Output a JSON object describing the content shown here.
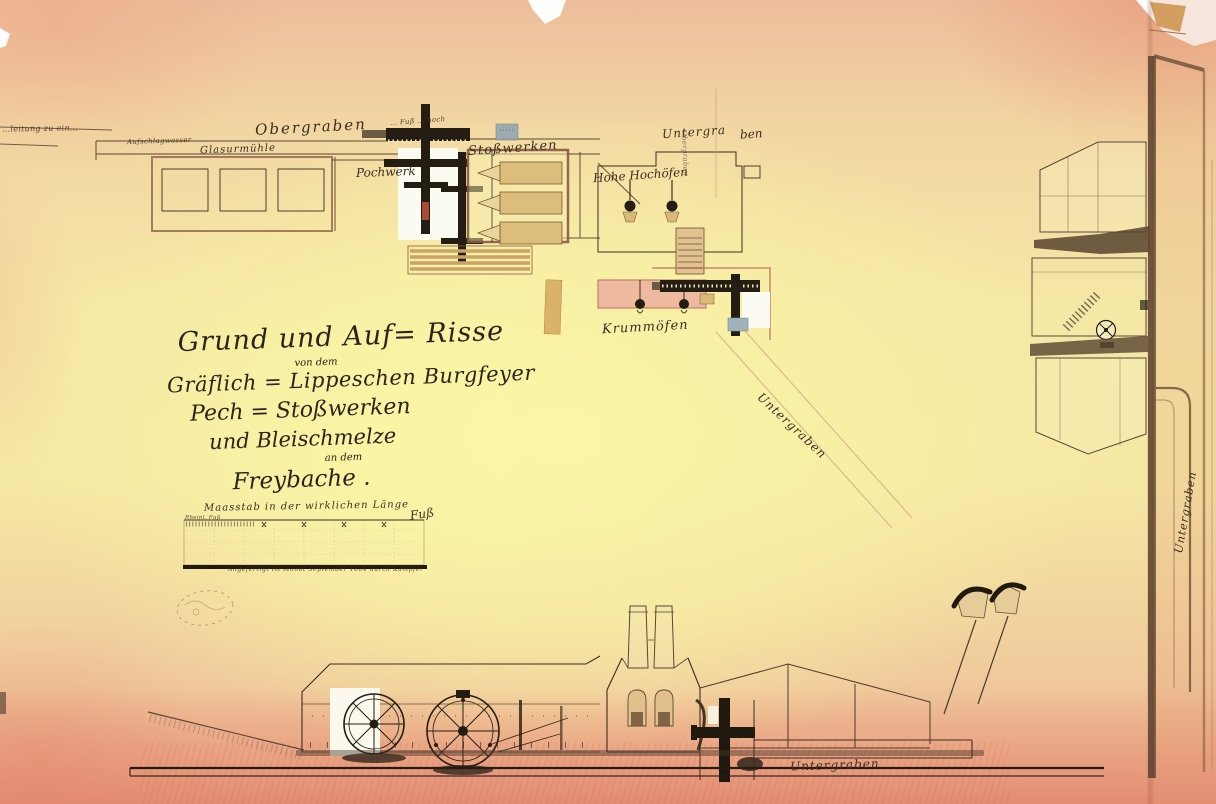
{
  "artwork": {
    "title": {
      "line1": "Grund und Auf= Risse",
      "line2": "von dem",
      "line3": "Gräflich = Lippeschen Burgfeyer",
      "line4": "Pech = Stoßwerken",
      "line5": "und Bleischmelze",
      "line6": "an dem",
      "line7": "Freybache ."
    },
    "labels": {
      "edge_fragment": "…leitung zu ein…",
      "obergraben_top": "Obergraben",
      "aufschlagwasser": "Aufschlagwasser",
      "glasurmuehle": "Glasurmühle",
      "wheel_note": "… Fuß … hoch",
      "pochwerk": "Pochwerk",
      "stosswerken": "Stoßwerken",
      "untergraben_top_left": "Untergra",
      "untergraben_top_right": "ben",
      "fold_vertical": "Obergraben",
      "hohe_hochoefen": "Hohe Hochöfen",
      "krummoefen": "Krummöfen",
      "untergraben_diagonal": "Untergraben",
      "untergraben_right": "Untergraben",
      "untergraben_bottom": "Untergraben"
    },
    "scale_bar": {
      "title": "Maasstab in der wirklichen Länge",
      "unit": "Fuß",
      "left_note": "Rheinl. Fuß",
      "caption": "Angefertigt im Monat September 1804 durch Kämpfer"
    },
    "colors": {
      "paper_center": "#f8f1a8",
      "paper_edge_pink": "#e9a38a",
      "ink": "#3a2e22",
      "wall_wash": "#efb9a0",
      "wood_wash": "#dcbd7c",
      "blue_patch": "#93a7b1"
    }
  }
}
